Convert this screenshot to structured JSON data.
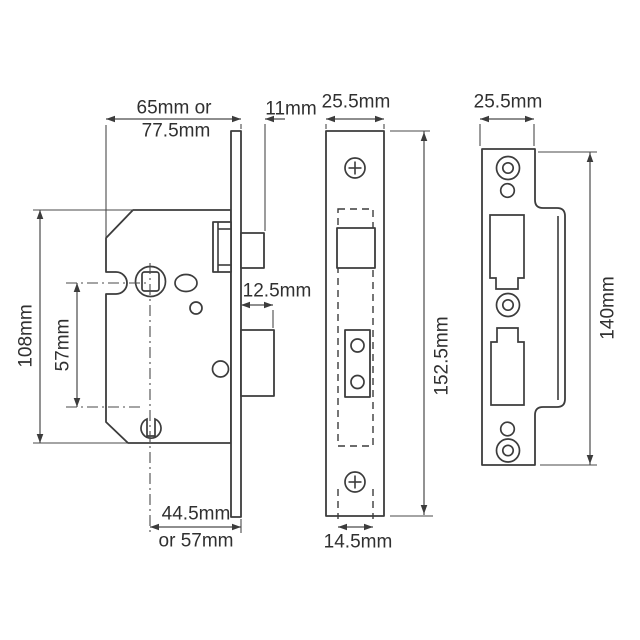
{
  "colors": {
    "background": "#ffffff",
    "line": "#3c3c3c",
    "dimension_line": "#4a4a4a",
    "text": "#303030"
  },
  "views": {
    "lock_body_side": {
      "dims": {
        "case_width_line1": "65mm or",
        "case_width_line2": "77.5mm",
        "faceplate_to_latch": "11mm",
        "deadbolt_throw": "12.5mm",
        "case_height": "108mm",
        "spindle_to_keyhole": "57mm",
        "backset_line1": "44.5mm",
        "backset_line2": "or 57mm"
      }
    },
    "faceplate_front": {
      "dims": {
        "width": "25.5mm",
        "height": "152.5mm",
        "case_width": "14.5mm"
      }
    },
    "strike_plate": {
      "dims": {
        "width": "25.5mm",
        "height": "140mm"
      }
    }
  }
}
